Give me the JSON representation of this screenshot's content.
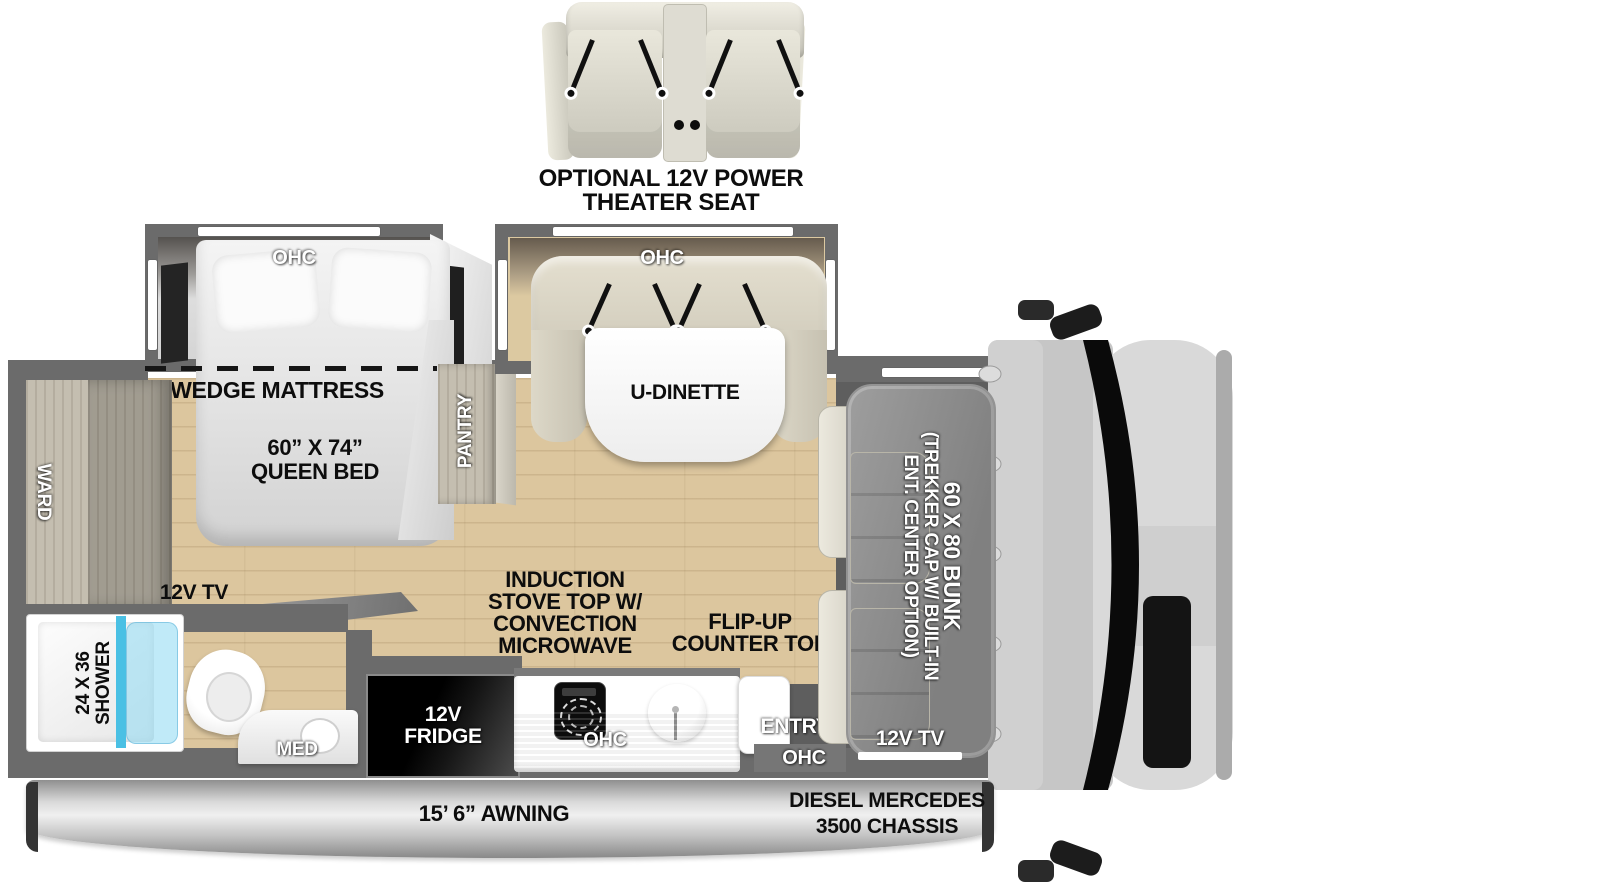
{
  "optional_seat": {
    "line1": "OPTIONAL 12V POWER",
    "line2": "THEATER SEAT"
  },
  "bedroom_slide": {
    "ohc": "OHC"
  },
  "dinette_slide": {
    "ohc": "OHC",
    "table": "U-DINETTE"
  },
  "bedroom": {
    "wedge_mattress": "WEDGE MATTRESS",
    "queen_size": "60” X 74”",
    "queen_name": "QUEEN BED",
    "pantry": "PANTRY",
    "wardrobe": "WARD",
    "tv": "12V TV"
  },
  "bathroom": {
    "shower_size": "24 X 36",
    "shower_name": "SHOWER",
    "med": "MED"
  },
  "kitchen": {
    "fridge_l1": "12V",
    "fridge_l2": "FRIDGE",
    "stove_l1": "INDUCTION",
    "stove_l2": "STOVE TOP W/",
    "stove_l3": "CONVECTION",
    "stove_l4": "MICROWAVE",
    "ohc": "OHC",
    "flip_l1": "FLIP-UP",
    "flip_l2": "COUNTER TOP"
  },
  "entry": {
    "label": "ENTRY",
    "ohc": "OHC"
  },
  "cab": {
    "bunk_l1": "60 X 80 BUNK",
    "bunk_l2": "(TREKKER CAP W/ BUILT-IN",
    "bunk_l3": "ENT. CENTER OPTION)",
    "tv": "12V TV"
  },
  "exterior": {
    "awning": "15’ 6” AWNING",
    "chassis_l1": "DIESEL MERCEDES",
    "chassis_l2": "3500 CHASSIS"
  },
  "colors": {
    "wall": "#6b6b6b",
    "floor": "#dcc69e",
    "shower_glass": "#4ac0e4",
    "cab_body": "#c9c9c9"
  }
}
